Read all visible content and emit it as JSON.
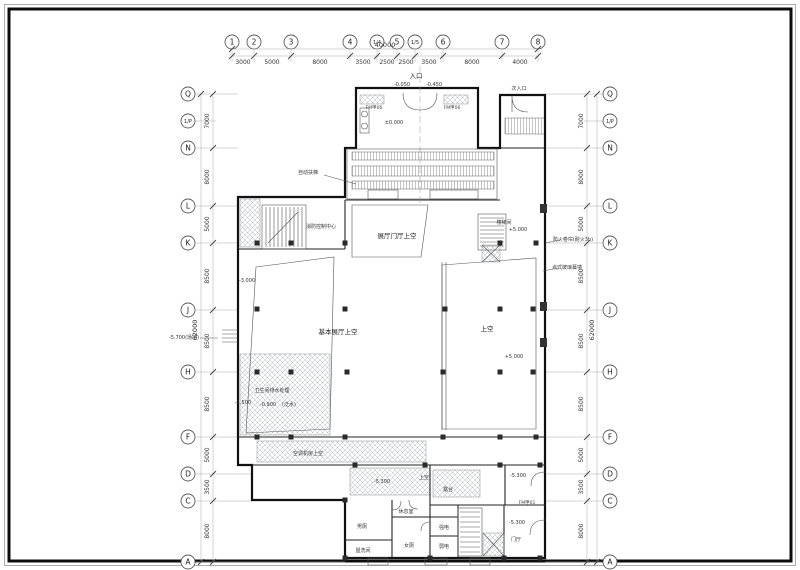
{
  "sheet": {
    "type": "architectural-floor-plan",
    "line_color": "#1a1a1a",
    "hatch_color": "#b4bac2",
    "paper_color": "#ffffff"
  },
  "grid": {
    "total_width_dim": "40000",
    "total_height_dim": "62000",
    "cols": [
      "1",
      "2",
      "3",
      "4",
      "1/4",
      "5",
      "1/5",
      "6",
      "7",
      "8"
    ],
    "col_dims": [
      "3000",
      "5000",
      "8000",
      "3500",
      "2500",
      "2500",
      "3500",
      "8000",
      "4000"
    ],
    "rows": [
      "Q",
      "1/P",
      "N",
      "L",
      "K",
      "J",
      "H",
      "F",
      "D",
      "C",
      "A"
    ],
    "row_dims": [
      "7000",
      "8000",
      "5000",
      "8500",
      "8500",
      "8500",
      "5000",
      "3500",
      "8000"
    ]
  },
  "labels": {
    "entrance": "入口",
    "sub_entrance": "次入口",
    "lvl_pm0": "±0.000",
    "lvl_m005": "-0.050",
    "lvl_m045": "-0.450",
    "escalator_note": "自动扶梯",
    "foyer_void": "展厅门厅上空",
    "fire_ctrl_room": "消防控制中心",
    "stair_room": "楼梯间",
    "lvl_p5_stair": "+5.000",
    "main_hall_void": "基本展厅上空",
    "void_right": "上空",
    "lvl_p5_void": "+5.000",
    "fire_shutter_note": "防火卷帘(耐火3h)",
    "curtain_wall_note": "点式玻璃幕墙",
    "toilet_note": "卫生间排水处理",
    "lvl_m15": "-1.500",
    "lvl_m09": "-0.900",
    "slope_note": "(泛水)",
    "lvl_m30": "-3.000",
    "site_level": "-5.700(场地)",
    "ac_room_void": "空调机房上空",
    "void_bottom": "上空",
    "terrace": "露台",
    "lvl_m53_a": "-5.300",
    "lvl_m53_b": "-5.300",
    "lvl_m53_c": "-5.300",
    "lounge": "休息室",
    "male_wc": "男厕",
    "female_wc": "女厕",
    "washroom": "盥洗间",
    "strong_elec": "强电",
    "weak_elec": "弱电",
    "entry_hall": "门厅",
    "door_tag_a": "FM甲06",
    "door_tag_b": "FM甲06",
    "door_tag_c": "FM甲01"
  }
}
